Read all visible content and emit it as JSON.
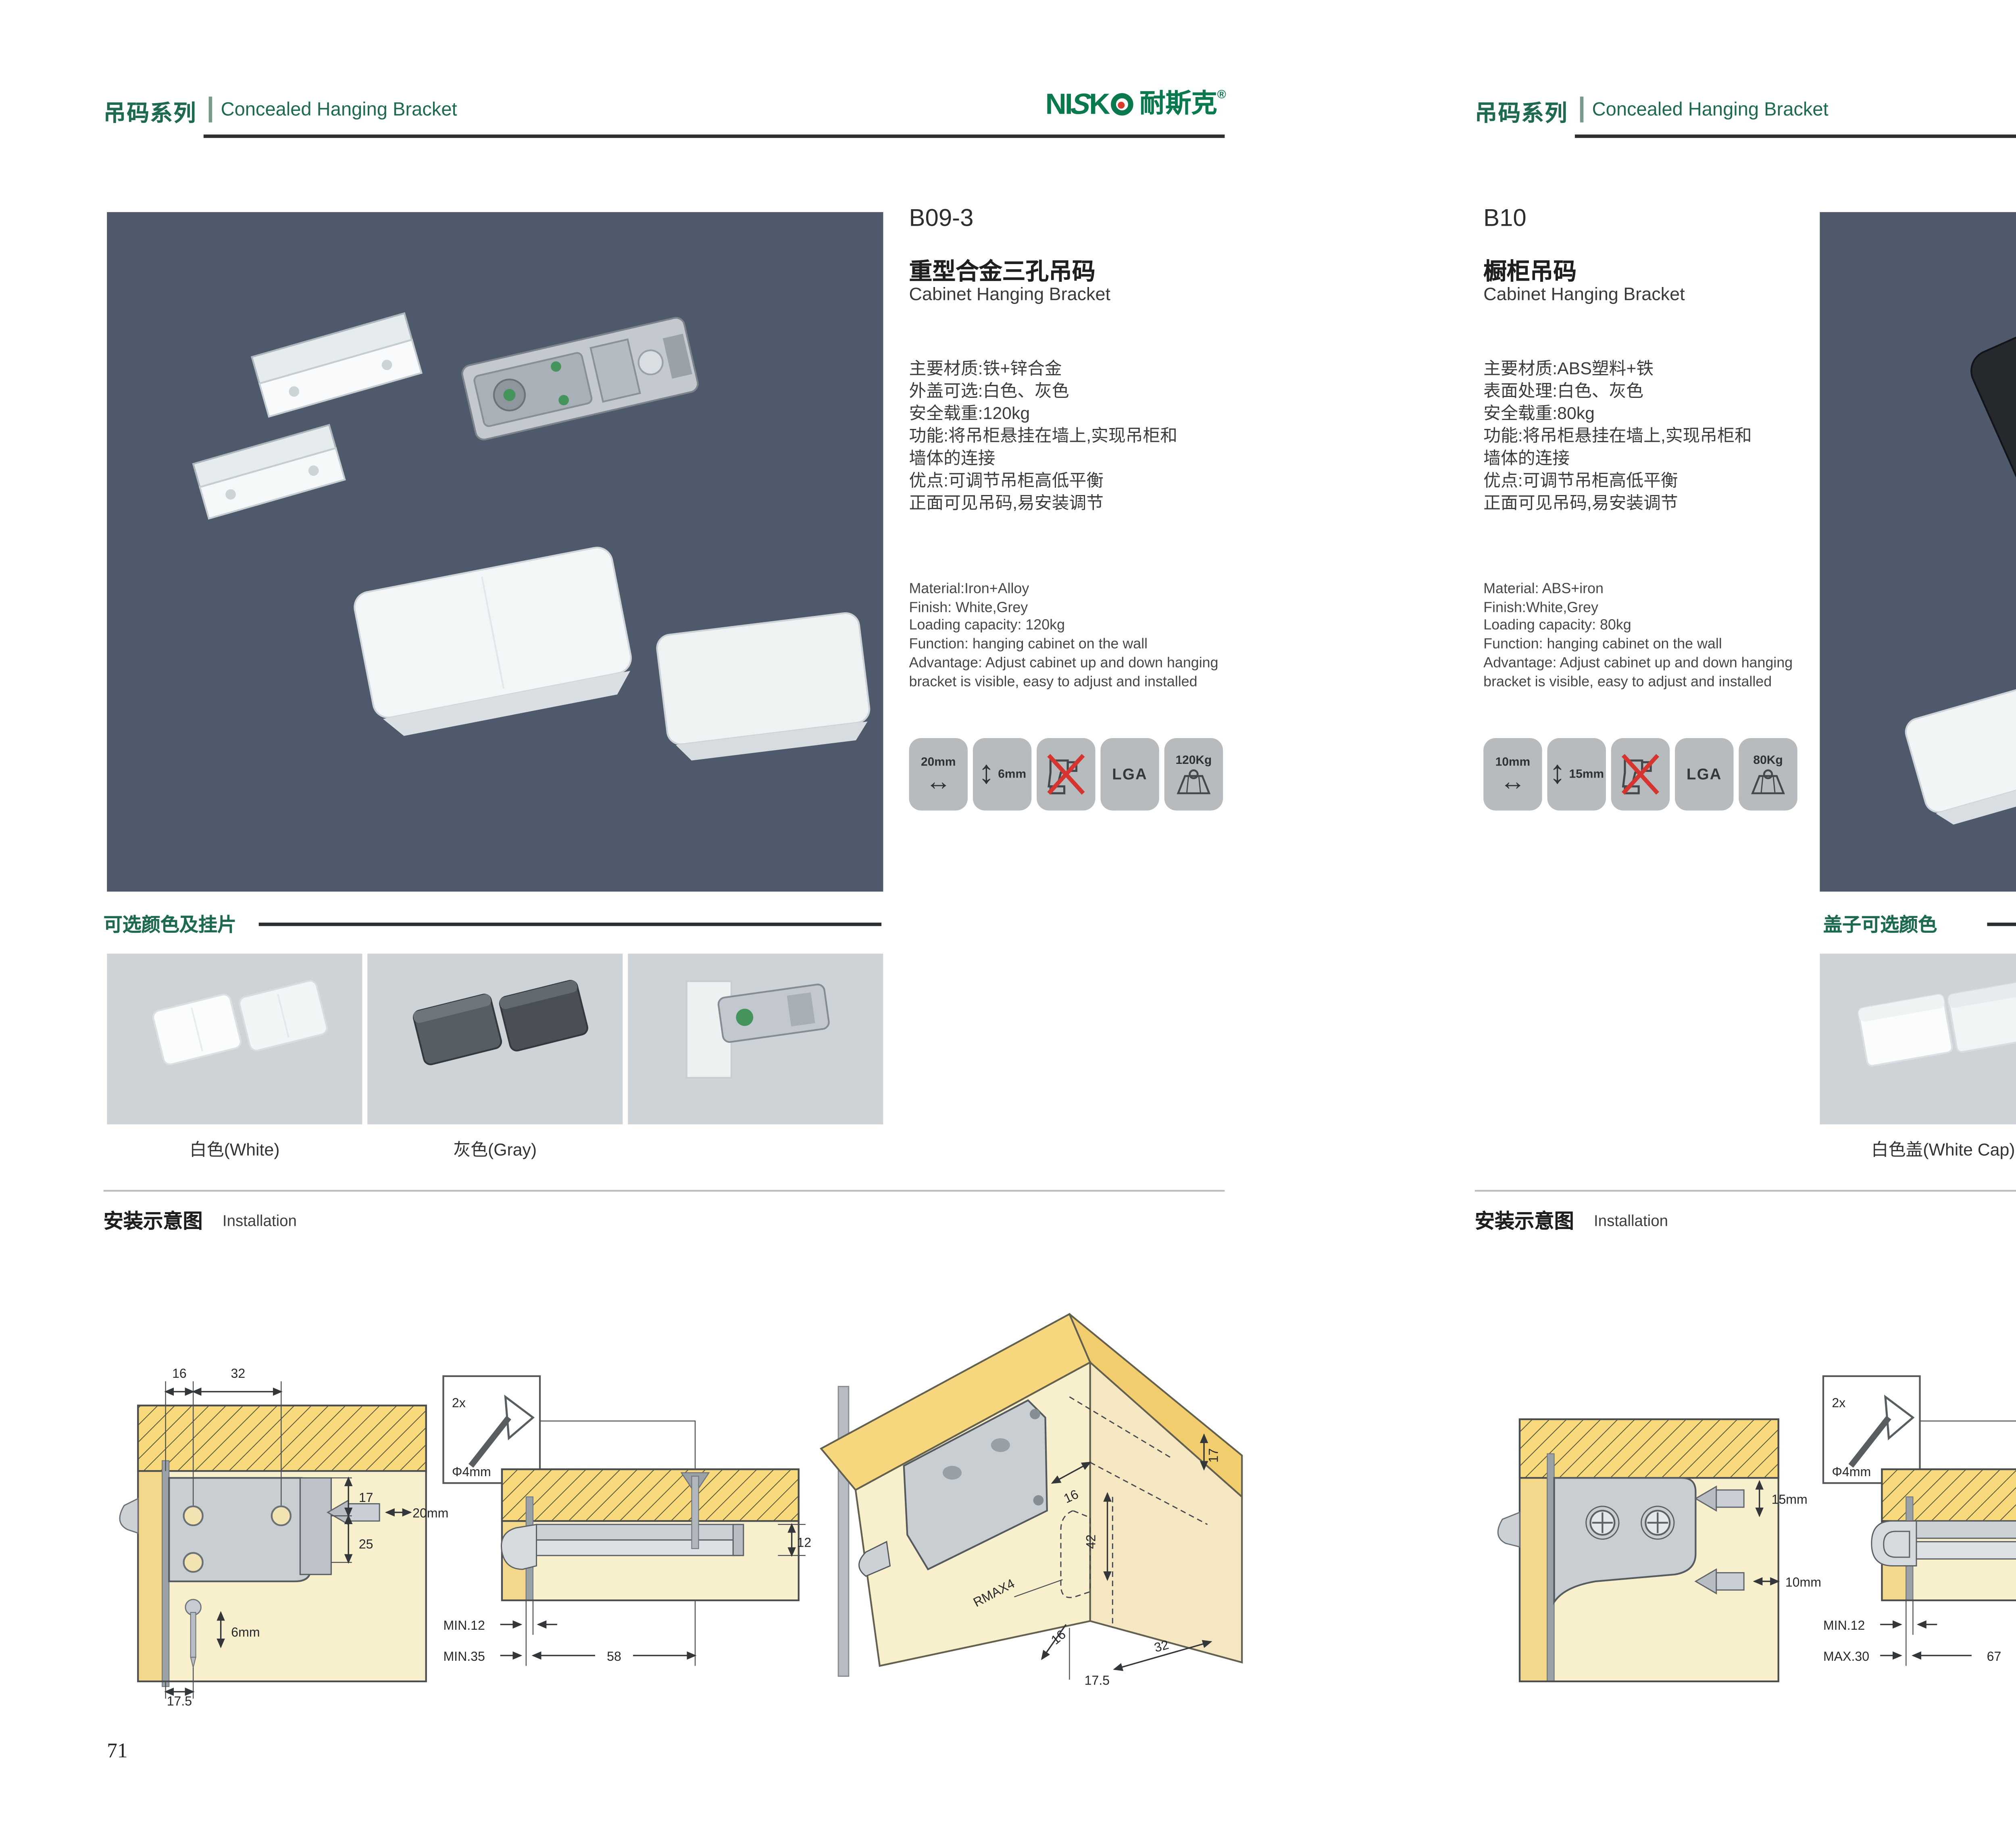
{
  "theme": {
    "green": "#1e6a50",
    "logo_green": "#0a7a4e",
    "logo_red": "#d93a2b",
    "photo_bg": "#4e596b",
    "swatch_bg": "#cdd3d7",
    "tile_bg": "#b7bbbe"
  },
  "glyphs": {
    "h_arrow": "↔",
    "v_arrow": "↕"
  },
  "brand": {
    "ni": "NI",
    "s": "S",
    "k": "K",
    "cn": "耐斯克",
    "reg": "®"
  },
  "pages": [
    {
      "page_number": "71",
      "header": {
        "series": "吊码系列",
        "subtitle": "Concealed Hanging Bracket"
      },
      "product": {
        "code": "B09-3",
        "title_zh": "重型合金三孔吊码",
        "title_en": "Cabinet Hanging Bracket"
      },
      "specs_zh": [
        "主要材质:铁+锌合金",
        "外盖可选:白色、灰色",
        "安全载重:120kg",
        "功能:将吊柜悬挂在墙上,实现吊柜和",
        "墙体的连接",
        "优点:可调节吊柜高低平衡",
        "正面可见吊码,易安装调节"
      ],
      "specs_en": [
        "Material:Iron+Alloy",
        "Finish: White,Grey",
        "Loading capacity: 120kg",
        "Function: hanging cabinet on the wall",
        "Advantage: Adjust cabinet up and down hanging",
        "bracket is visible, easy to adjust and installed"
      ],
      "icons": {
        "width": "20mm",
        "height": "6mm",
        "cert": "LGA",
        "load": "120Kg"
      },
      "colors_section": {
        "title": "可选颜色及挂片",
        "labels": [
          "白色(White)",
          "灰色(Gray)"
        ]
      },
      "install": {
        "title_zh": "安装示意图",
        "title_en": "Installation"
      },
      "diagrams": {
        "d1": {
          "top1": "16",
          "top2": "32",
          "r1": "17",
          "r2": "25",
          "bit1": "20mm",
          "bit2": "6mm",
          "bottom": "17.5"
        },
        "d2": {
          "qty": "2x",
          "dia": "Φ4mm",
          "right": "12",
          "b1": "MIN.12",
          "b2": "MIN.35",
          "b3": "58"
        },
        "d3": {
          "r": "17",
          "t": "16",
          "v": "42",
          "rmax": "RMAX4",
          "b0": "16",
          "b1": "17.5",
          "b2": "32"
        }
      }
    },
    {
      "page_number": "72",
      "header": {
        "series": "吊码系列",
        "subtitle": "Concealed Hanging Bracket"
      },
      "product": {
        "code": "B10",
        "title_zh": "橱柜吊码",
        "title_en": "Cabinet Hanging Bracket"
      },
      "specs_zh": [
        "主要材质:ABS塑料+铁",
        "表面处理:白色、灰色",
        "安全载重:80kg",
        "功能:将吊柜悬挂在墙上,实现吊柜和",
        "墙体的连接",
        "优点:可调节吊柜高低平衡",
        "正面可见吊码,易安装调节"
      ],
      "specs_en": [
        "Material: ABS+iron",
        "Finish:White,Grey",
        "Loading capacity: 80kg",
        "Function: hanging cabinet on the wall",
        "Advantage: Adjust cabinet up and down hanging",
        "bracket is visible, easy to adjust and installed"
      ],
      "icons": {
        "width": "10mm",
        "height": "15mm",
        "cert": "LGA",
        "load": "80Kg"
      },
      "colors_section": {
        "title": "盖子可选颜色",
        "labels": [
          "白色盖(White Cap)",
          "灰色盖(Gray Cap)"
        ]
      },
      "install": {
        "title_zh": "安装示意图",
        "title_en": "Installation"
      },
      "diagrams": {
        "d1": {
          "bit1": "15mm",
          "bit2": "10mm"
        },
        "d2": {
          "qty": "2x",
          "dia": "Φ4mm",
          "right": "18",
          "b1": "MIN.12",
          "b2": "MAX.30",
          "b3": "67"
        },
        "d3": {
          "r": "13",
          "v": "42",
          "rmax": "RMAX4",
          "b0": "19",
          "b1": "17",
          "b2": "32"
        }
      }
    }
  ]
}
